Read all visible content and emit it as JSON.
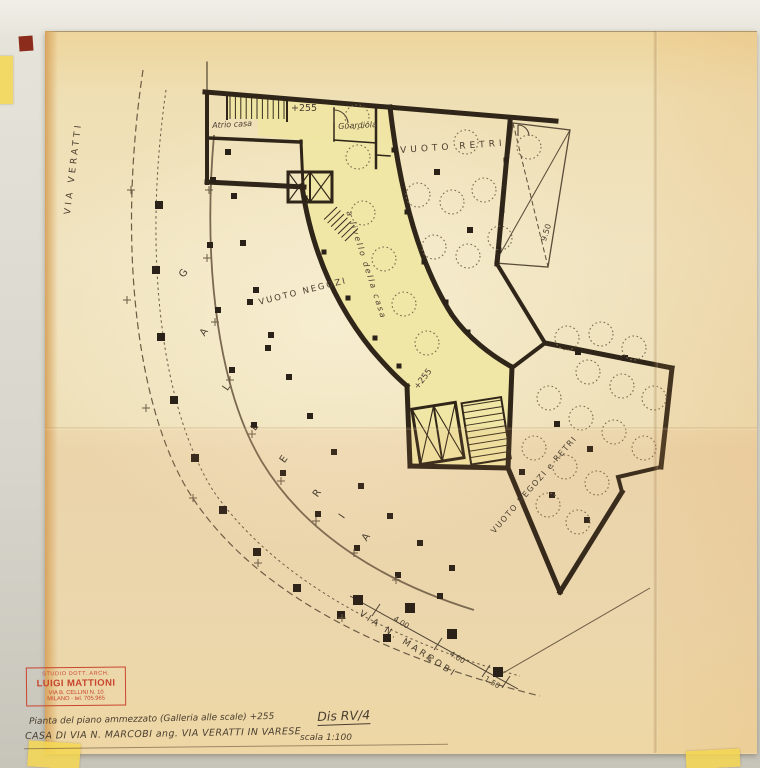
{
  "plan": {
    "street_left": "VIA VERATTI",
    "street_bottom": "VIA N. MARCOBI",
    "area_top": "VUOTO RETRI",
    "area_left": "VUOTO NEGOZI",
    "area_bottom_right": "VUOTO NEGOZI e RETRI",
    "room_atrio": "Atrio casa",
    "room_guardiola": "Guardiola",
    "corridor_note": "a livello della casa",
    "level_top": "+255",
    "level_mid": "+255",
    "galleria_letters": [
      "G",
      "A",
      "L",
      "L",
      "E",
      "R",
      "I",
      "A"
    ],
    "dims": {
      "marcobi_1": "4.00",
      "marcobi_2": "4.00",
      "marcobi_3": "1.50",
      "roof_width": "9.50"
    }
  },
  "stamp": {
    "line1": "STUDIO DOTT. ARCH.",
    "name": "LUIGI MATTIONI",
    "address": "VIA B. CELLINI N. 10",
    "city_tel": "MILANO - tel. 705.965"
  },
  "titleblock": {
    "description": "Pianta del piano ammezzato (Galleria alle scale) +255",
    "drawing_number": "Dis RV/4",
    "project": "CASA DI VIA N. MARCOBI ang. VIA VERATTI IN VARESE",
    "scale": "scala 1:100"
  },
  "colors": {
    "paper": "#eddcb0",
    "highlight_yellow": "#efe6a2",
    "wall_ink": "#2f2518",
    "pencil": "#4e4232",
    "stamp_red": "#c64a32"
  }
}
